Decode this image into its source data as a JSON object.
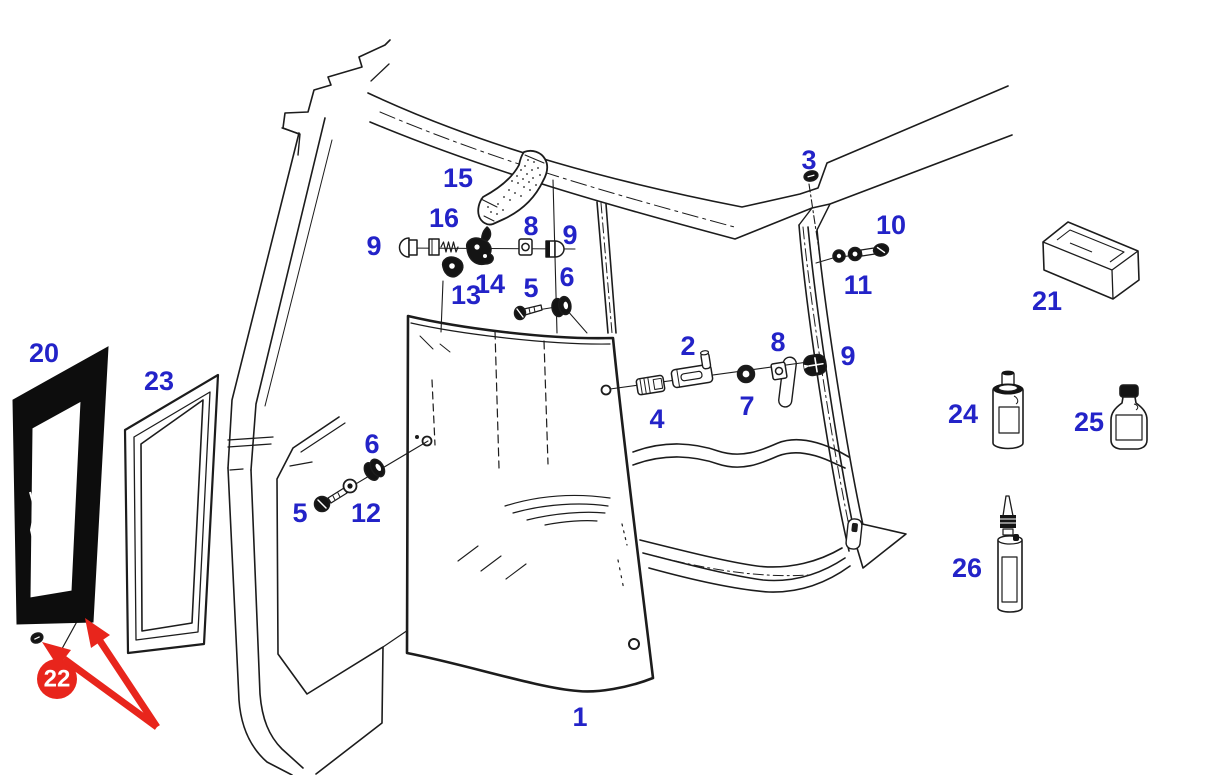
{
  "diagram": {
    "type": "exploded-parts-diagram",
    "subject": "cab-door-window-assembly",
    "background": "#ffffff",
    "line_color": "#1c1c1c",
    "label_color": "#2323c8",
    "highlight_color": "#e8251c",
    "part_labels": [
      {
        "part": "1",
        "x": 580,
        "y": 717
      },
      {
        "part": "2",
        "x": 688,
        "y": 346
      },
      {
        "part": "3",
        "x": 809,
        "y": 160
      },
      {
        "part": "4",
        "x": 657,
        "y": 419
      },
      {
        "part": "5",
        "x": 531,
        "y": 288
      },
      {
        "part": "5",
        "x": 300,
        "y": 513
      },
      {
        "part": "6",
        "x": 567,
        "y": 277
      },
      {
        "part": "6",
        "x": 372,
        "y": 444
      },
      {
        "part": "7",
        "x": 747,
        "y": 406
      },
      {
        "part": "8",
        "x": 531,
        "y": 226
      },
      {
        "part": "8",
        "x": 778,
        "y": 342
      },
      {
        "part": "9",
        "x": 374,
        "y": 246
      },
      {
        "part": "9",
        "x": 570,
        "y": 235
      },
      {
        "part": "9",
        "x": 848,
        "y": 356
      },
      {
        "part": "10",
        "x": 891,
        "y": 225
      },
      {
        "part": "11",
        "x": 858,
        "y": 285
      },
      {
        "part": "12",
        "x": 366,
        "y": 513
      },
      {
        "part": "13",
        "x": 466,
        "y": 295
      },
      {
        "part": "14",
        "x": 490,
        "y": 284
      },
      {
        "part": "15",
        "x": 458,
        "y": 178
      },
      {
        "part": "16",
        "x": 444,
        "y": 218
      },
      {
        "part": "20",
        "x": 44,
        "y": 353
      },
      {
        "part": "21",
        "x": 1047,
        "y": 301
      },
      {
        "part": "23",
        "x": 159,
        "y": 381
      },
      {
        "part": "24",
        "x": 963,
        "y": 414
      },
      {
        "part": "25",
        "x": 1089,
        "y": 422
      },
      {
        "part": "26",
        "x": 967,
        "y": 568
      }
    ],
    "highlight": {
      "part": "22",
      "x": 57,
      "y": 679,
      "radius": 20,
      "text_color": "#ffffff"
    }
  }
}
